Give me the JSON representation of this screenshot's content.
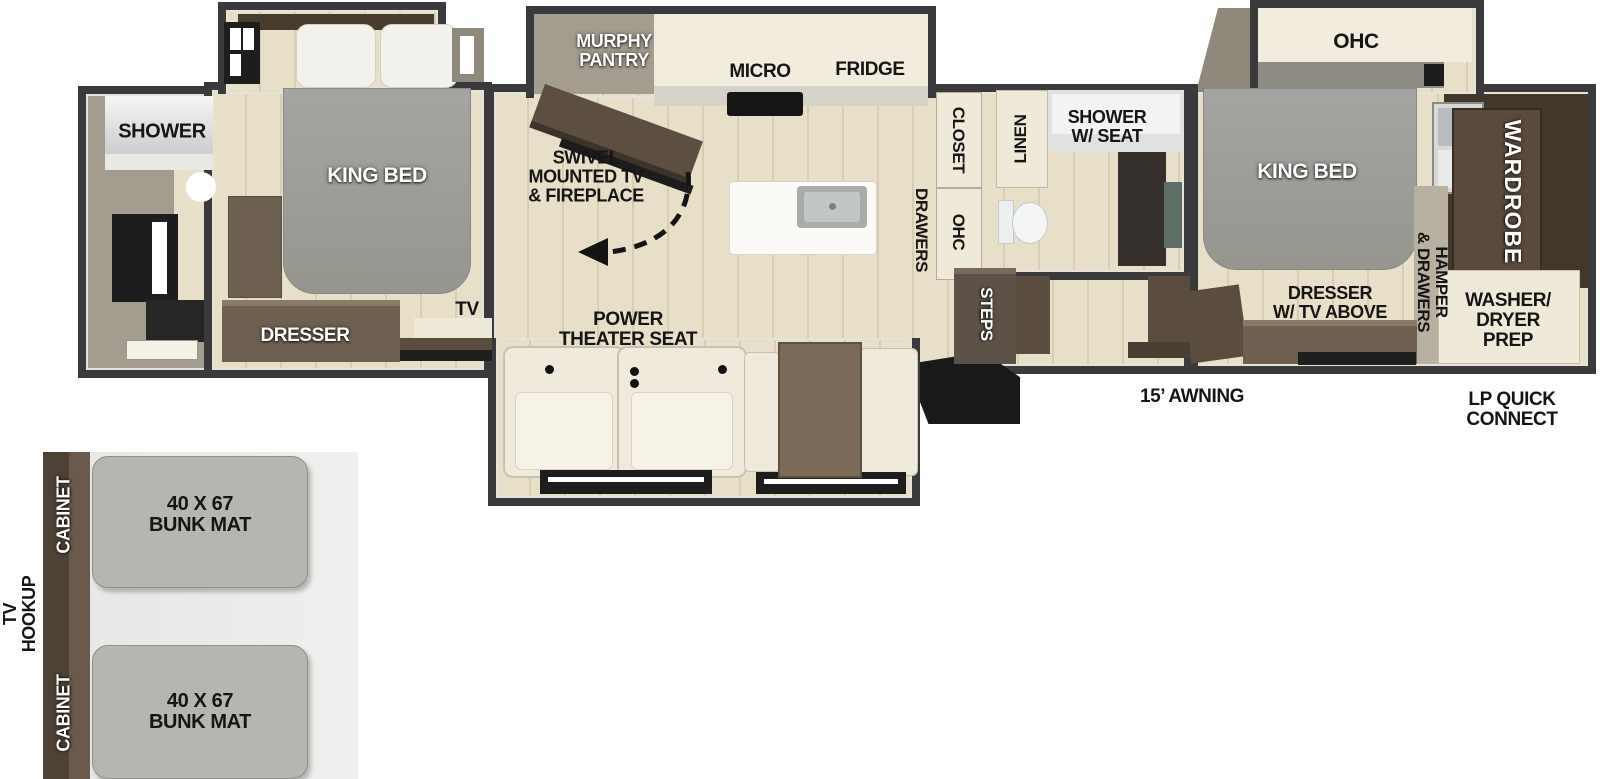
{
  "floorplan": {
    "rear_bath": {
      "shower": "SHOWER"
    },
    "rear_bedroom": {
      "king_bed": "KING BED",
      "dresser": "DRESSER",
      "tv": "TV"
    },
    "living_kitchen": {
      "murphy_pantry": "MURPHY\nPANTRY",
      "micro": "MICRO",
      "fridge": "FRIDGE",
      "swivel_tv": "SWIVEL\nMOUNTED TV\n& FIREPLACE",
      "power_theater_seat": "POWER\nTHEATER SEAT",
      "closet": "CLOSET",
      "drawers": "DRAWERS",
      "ohc": "OHC"
    },
    "mid_bath": {
      "linen": "LINEN",
      "shower_w_seat": "SHOWER\nW/ SEAT",
      "steps": "STEPS"
    },
    "front_bedroom": {
      "ohc": "OHC",
      "king_bed": "KING BED",
      "wardrobe": "WARDROBE",
      "hamper_drawers": "HAMPER\n& DRAWERS",
      "dresser_tv": "DRESSER\nW/ TV ABOVE",
      "washer_dryer": "WASHER/\nDRYER\nPREP"
    },
    "exterior": {
      "awning": "15’ AWNING",
      "lp_quick_connect": "LP QUICK\nCONNECT"
    },
    "bunk_room": {
      "cabinets": [
        "CABINET",
        "CABINET"
      ],
      "bunk_mats": [
        "40 X 67\nBUNK MAT",
        "40 X 67\nBUNK MAT"
      ],
      "tv_hookup": "TV\nHOOKUP"
    }
  },
  "colors": {
    "wall": "#3a3a3c",
    "wall_inner": "#a39c8f",
    "floor": "#e8dfc9",
    "cabinet_cream": "#f1ecdd",
    "furniture_brown": "#6e6051",
    "dark_brown": "#43372c",
    "bed_gray": "#9e9e9c",
    "mat_gray": "#b5b5b2",
    "bunk_strip_brown": "#57483c",
    "label_dark": "#151515",
    "label_light": "#ffffff"
  }
}
